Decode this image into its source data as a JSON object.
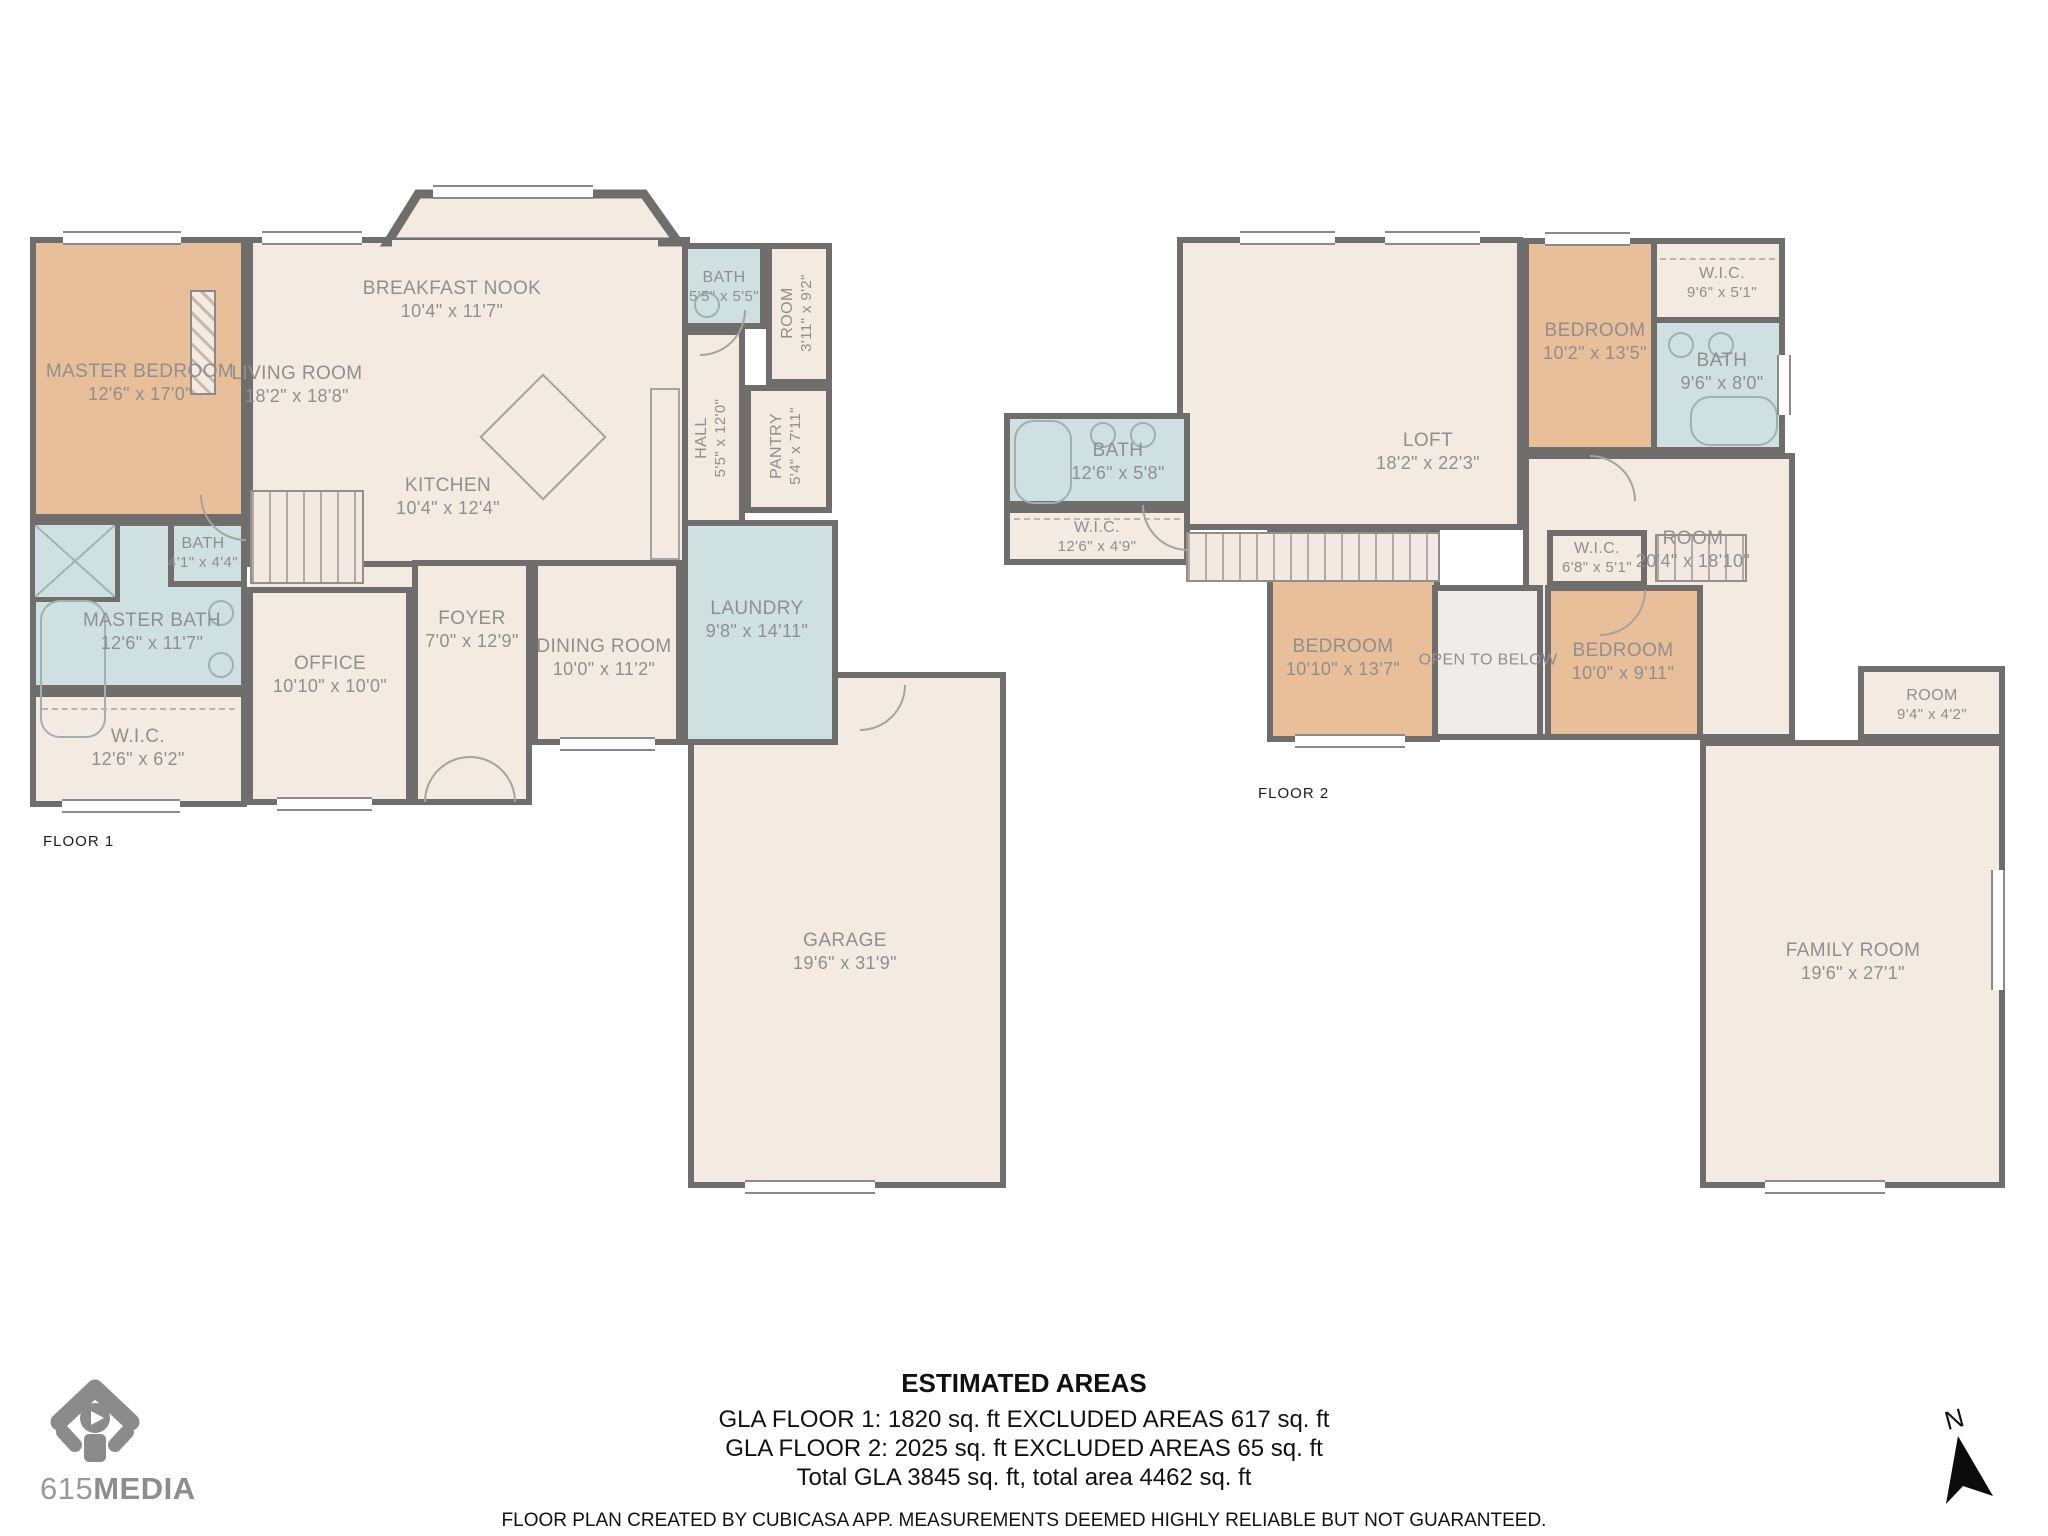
{
  "floor1": {
    "label": "FLOOR 1",
    "rooms": {
      "master_bedroom": {
        "name": "MASTER BEDROOM",
        "dims": "12'6\" x 17'0\""
      },
      "living_room": {
        "name": "LIVING ROOM",
        "dims": "18'2\" x 18'8\""
      },
      "breakfast_nook": {
        "name": "BREAKFAST NOOK",
        "dims": "10'4\" x 11'7\""
      },
      "kitchen": {
        "name": "KITCHEN",
        "dims": "10'4\" x 12'4\""
      },
      "bath_upper": {
        "name": "BATH",
        "dims": "5'5\" x 5'5\""
      },
      "room_side": {
        "name": "ROOM",
        "dims": "3'11\" x 9'2\""
      },
      "hall": {
        "name": "HALL",
        "dims": "5'5\" x 12'0\""
      },
      "pantry": {
        "name": "PANTRY",
        "dims": "5'4\" x 7'11\""
      },
      "bath_small": {
        "name": "BATH",
        "dims": "4'1\" x 4'4\""
      },
      "master_bath": {
        "name": "MASTER BATH",
        "dims": "12'6\" x 11'7\""
      },
      "wic": {
        "name": "W.I.C.",
        "dims": "12'6\" x 6'2\""
      },
      "office": {
        "name": "OFFICE",
        "dims": "10'10\" x 10'0\""
      },
      "foyer": {
        "name": "FOYER",
        "dims": "7'0\" x 12'9\""
      },
      "dining_room": {
        "name": "DINING ROOM",
        "dims": "10'0\" x 11'2\""
      },
      "laundry": {
        "name": "LAUNDRY",
        "dims": "9'8\" x 14'11\""
      },
      "garage": {
        "name": "GARAGE",
        "dims": "19'6\" x 31'9\""
      }
    }
  },
  "floor2": {
    "label": "FLOOR 2",
    "rooms": {
      "loft": {
        "name": "LOFT",
        "dims": "18'2\" x 22'3\""
      },
      "bath_left": {
        "name": "BATH",
        "dims": "12'6\" x 5'8\""
      },
      "wic_left": {
        "name": "W.I.C.",
        "dims": "12'6\" x 4'9\""
      },
      "bedroom_top": {
        "name": "BEDROOM",
        "dims": "10'2\" x 13'5\""
      },
      "wic_top": {
        "name": "W.I.C.",
        "dims": "9'6\" x 5'1\""
      },
      "bath_top": {
        "name": "BATH",
        "dims": "9'6\" x 8'0\""
      },
      "room_big": {
        "name": "ROOM",
        "dims": "20'4\" x 18'10\""
      },
      "wic_small": {
        "name": "W.I.C.",
        "dims": "6'8\" x 5'1\""
      },
      "open_below": {
        "name": "OPEN TO BELOW",
        "dims": ""
      },
      "bedroom_mid": {
        "name": "BEDROOM",
        "dims": "10'0\" x 9'11\""
      },
      "bedroom_low": {
        "name": "BEDROOM",
        "dims": "10'10\" x 13'7\""
      },
      "room_small": {
        "name": "ROOM",
        "dims": "9'4\" x 4'2\""
      },
      "family_room": {
        "name": "FAMILY ROOM",
        "dims": "19'6\" x 27'1\""
      }
    }
  },
  "areas": {
    "heading": "ESTIMATED AREAS",
    "gla_floor1": "GLA FLOOR 1: 1820 sq. ft EXCLUDED AREAS 617 sq. ft",
    "gla_floor2": "GLA FLOOR 2: 2025 sq. ft EXCLUDED AREAS 65 sq. ft",
    "total": "Total GLA 3845 sq. ft, total area 4462 sq. ft",
    "disclaimer": "FLOOR PLAN CREATED BY CUBICASA APP. MEASUREMENTS DEEMED HIGHLY RELIABLE BUT NOT GUARANTEED."
  },
  "logo": {
    "brand_number": "615",
    "brand_word": "MEDIA"
  },
  "compass": {
    "north": "N"
  },
  "palette": {
    "wall": "#6f6e6c",
    "floor": "#f3eae2",
    "bedroom_fill": "#e9bf99",
    "wet_room_fill": "#cfe0e0",
    "open_area_fill": "#efece9",
    "label_text": "#8f8f8f"
  }
}
